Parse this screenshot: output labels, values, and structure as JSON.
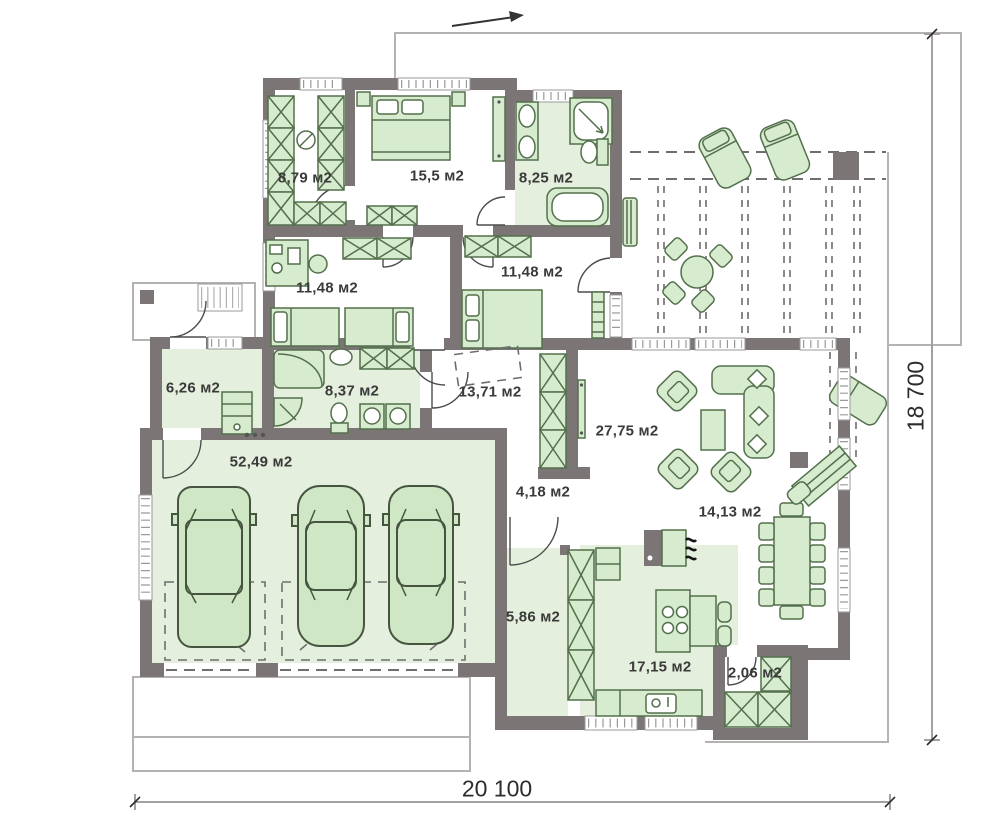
{
  "plan": {
    "rooms": [
      {
        "id": "wardrobe",
        "area": "8,79 м2"
      },
      {
        "id": "bedroom-1",
        "area": "15,5 м2"
      },
      {
        "id": "bathroom-1",
        "area": "8,25 м2"
      },
      {
        "id": "bedroom-2",
        "area": "11,48 м2"
      },
      {
        "id": "bedroom-3",
        "area": "11,48 м2"
      },
      {
        "id": "entry-hall",
        "area": "6,26 м2"
      },
      {
        "id": "bathroom-2",
        "area": "8,37 м2"
      },
      {
        "id": "corridor",
        "area": "13,71 м2"
      },
      {
        "id": "living-room",
        "area": "27,75 м2"
      },
      {
        "id": "garage",
        "area": "52,49 м2"
      },
      {
        "id": "hall",
        "area": "4,18 м2"
      },
      {
        "id": "dining-room",
        "area": "14,13 м2"
      },
      {
        "id": "passage",
        "area": "5,86 м2"
      },
      {
        "id": "kitchen",
        "area": "17,15 м2"
      },
      {
        "id": "pantry",
        "area": "2,06 м2"
      }
    ],
    "dimensions": {
      "width_label": "20 100",
      "height_label": "18 700"
    },
    "colors": {
      "wall": "#7b7576",
      "floor": "#e5efdd",
      "furniture_fill": "#d7ebcf",
      "furniture_stroke": "#53704c",
      "car_fill": "#cfe7c5",
      "car_stroke": "#46553f",
      "dash": "#6e6e6e",
      "outline": "#b5b2b2",
      "text": "#3a3a3a"
    }
  }
}
